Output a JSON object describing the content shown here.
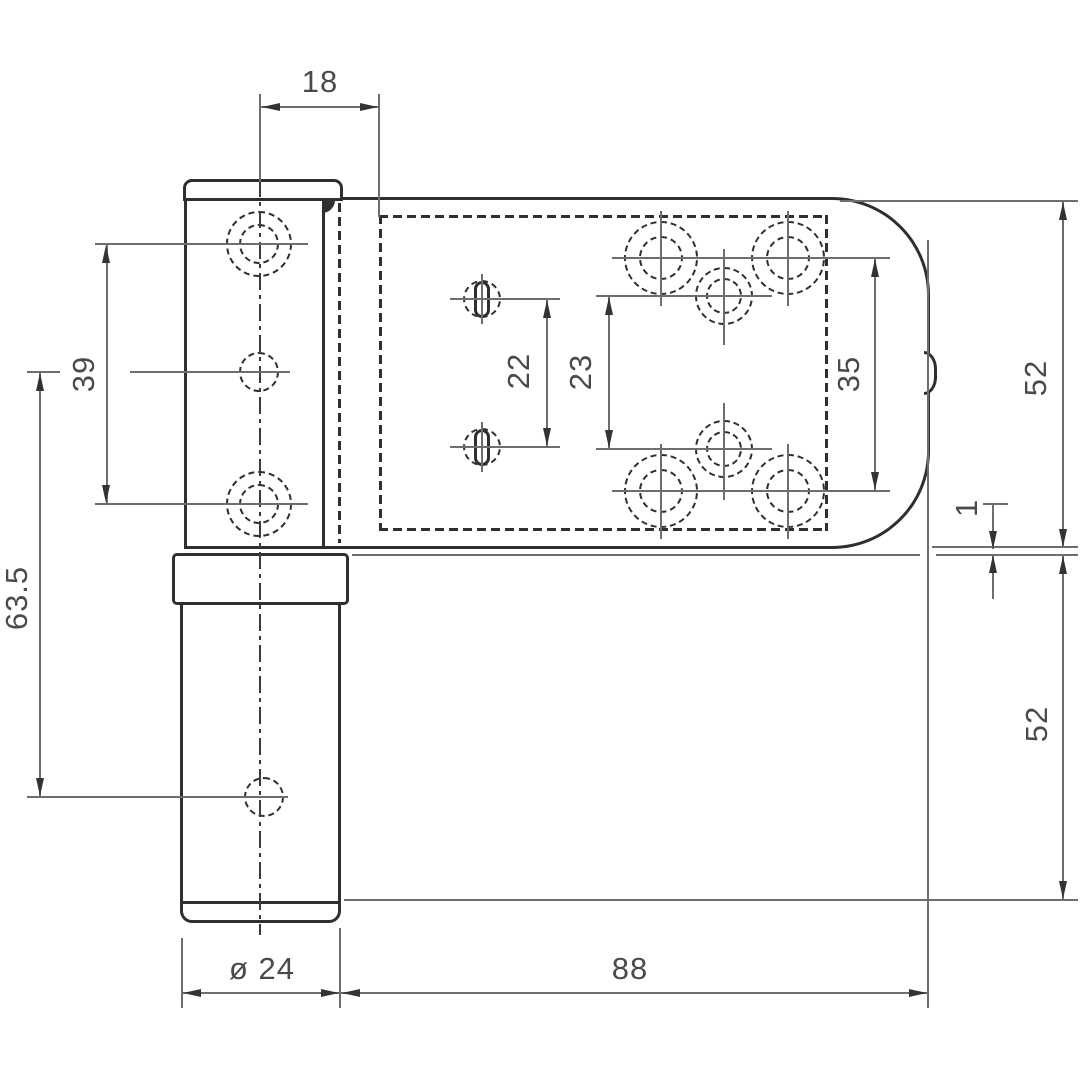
{
  "drawing": {
    "kind": "hinge technical drawing",
    "dimensions": {
      "d18": "18",
      "d39": "39",
      "d63_5": "63.5",
      "d22": "22",
      "d23": "23",
      "d35": "35",
      "d52_top": "52",
      "d1": "1",
      "d52_bottom": "52",
      "dia24": "ø 24",
      "d88": "88"
    },
    "colors": {
      "object_line": "#2f2f2f",
      "dimension_line": "#6e6e6e",
      "text": "#4a4a4a",
      "background": "#ffffff"
    }
  }
}
